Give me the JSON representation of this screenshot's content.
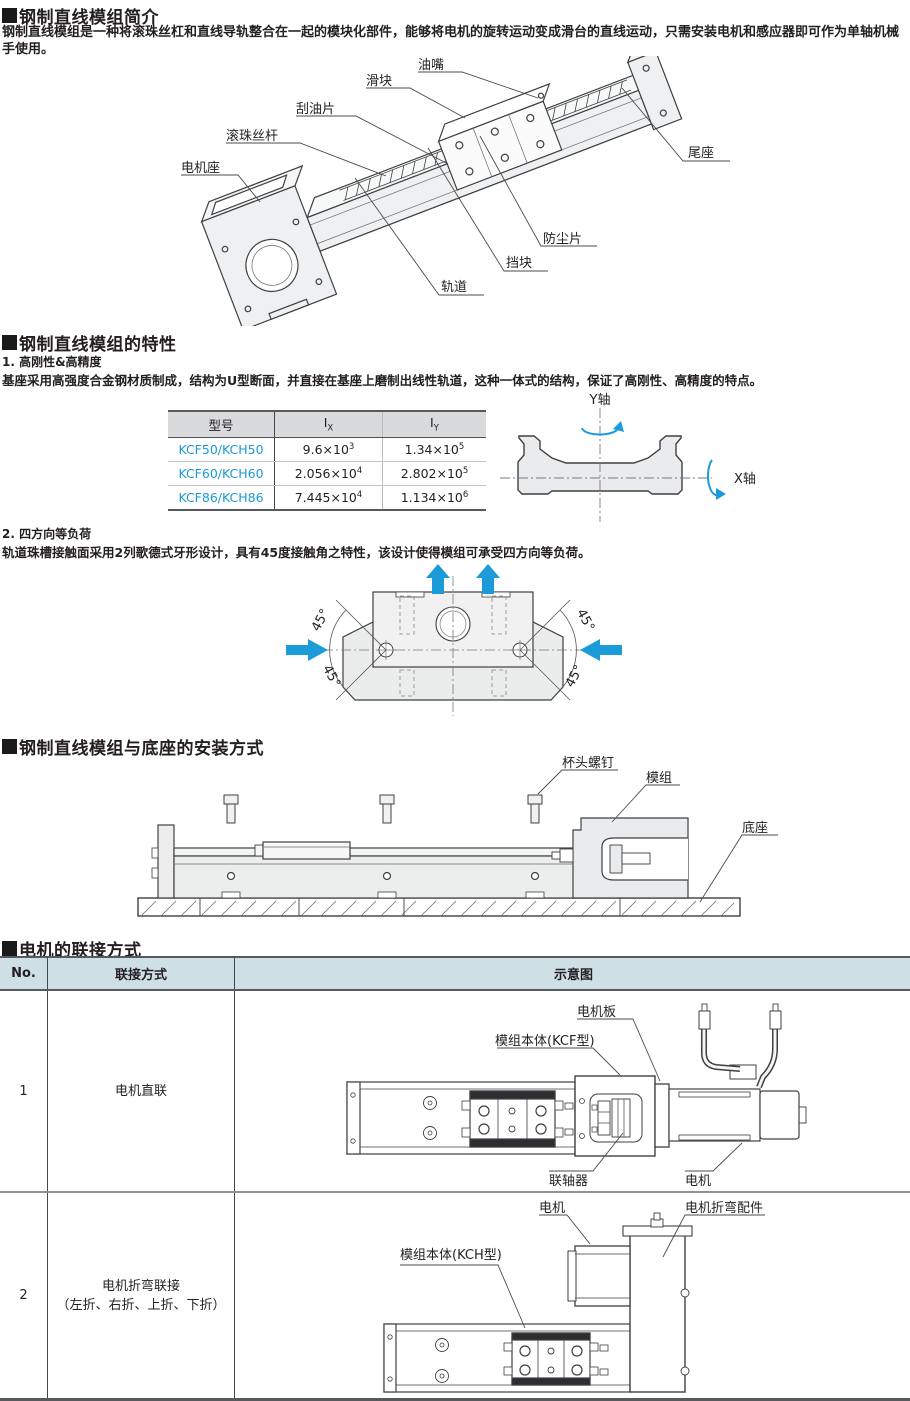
{
  "intro": {
    "title": "钢制直线模组简介",
    "body": "钢制直线模组是一种将滚珠丝杠和直线导轨整合在一起的模块化部件，能够将电机的旋转运动变成滑台的直线运动，只需安装电机和感应器即可作为单轴机械手使用。"
  },
  "overview": {
    "labels": {
      "oil_nozzle": "油嘴",
      "slider": "滑块",
      "oil_wiper": "刮油片",
      "ball_screw": "滚珠丝杆",
      "motor_mount": "电机座",
      "tail_seat": "尾座",
      "dust_plate": "防尘片",
      "stopper": "挡块",
      "rail": "轨道"
    }
  },
  "features": {
    "title": "钢制直线模组的特性",
    "item1_title": "1. 高刚性&高精度",
    "item1_body": "基座采用高强度合金钢材质制成，结构为U型断面，并直接在基座上磨制出线性轨道，这种一体式的结构，保证了高刚性、高精度的特点。",
    "item2_title": "2. 四方向等负荷",
    "item2_body": "轨道珠槽接触面采用2列歌德式牙形设计，具有45度接触角之特性，该设计使得模组可承受四方向等负荷。"
  },
  "inertia_table": {
    "col_model": "型号",
    "col_i": "I",
    "col_ix_sub": "X",
    "col_iy_sub": "Y",
    "rows": [
      {
        "model": "KCF50/KCH50",
        "ix": "9.6×10",
        "ix_e": "3",
        "iy": "1.34×10",
        "iy_e": "5"
      },
      {
        "model": "KCF60/KCH60",
        "ix": "2.056×10",
        "ix_e": "4",
        "iy": "2.802×10",
        "iy_e": "5"
      },
      {
        "model": "KCF86/KCH86",
        "ix": "7.445×10",
        "ix_e": "4",
        "iy": "1.134×10",
        "iy_e": "6"
      }
    ]
  },
  "axis_diagram": {
    "y_axis": "Y轴",
    "x_axis": "X轴"
  },
  "load_diagram": {
    "angle": "45°"
  },
  "mounting": {
    "title": "钢制直线模组与底座的安装方式",
    "labels": {
      "cap_screw": "杯头螺钉",
      "module": "模组",
      "base": "底座"
    }
  },
  "motor": {
    "title": "电机的联接方式",
    "headers": {
      "no": "No.",
      "method": "联接方式",
      "diagram": "示意图"
    },
    "rows": [
      {
        "no": "1",
        "method": "电机直联",
        "labels": {
          "motor_plate": "电机板",
          "module_body": "模组本体(KCF型)",
          "coupling": "联轴器",
          "motor": "电机"
        }
      },
      {
        "no": "2",
        "method_line1": "电机折弯联接",
        "method_line2": "（左折、右折、上折、下折）",
        "labels": {
          "motor": "电机",
          "bend_bracket": "电机折弯配件",
          "module_body": "模组本体(KCH型)"
        }
      }
    ]
  },
  "colors": {
    "accent_blue": "#1b9cd8",
    "link_blue": "#1a9ad4",
    "table1_header_bg": "#d9dadb",
    "motor_header_bg": "#cfdfe6"
  }
}
